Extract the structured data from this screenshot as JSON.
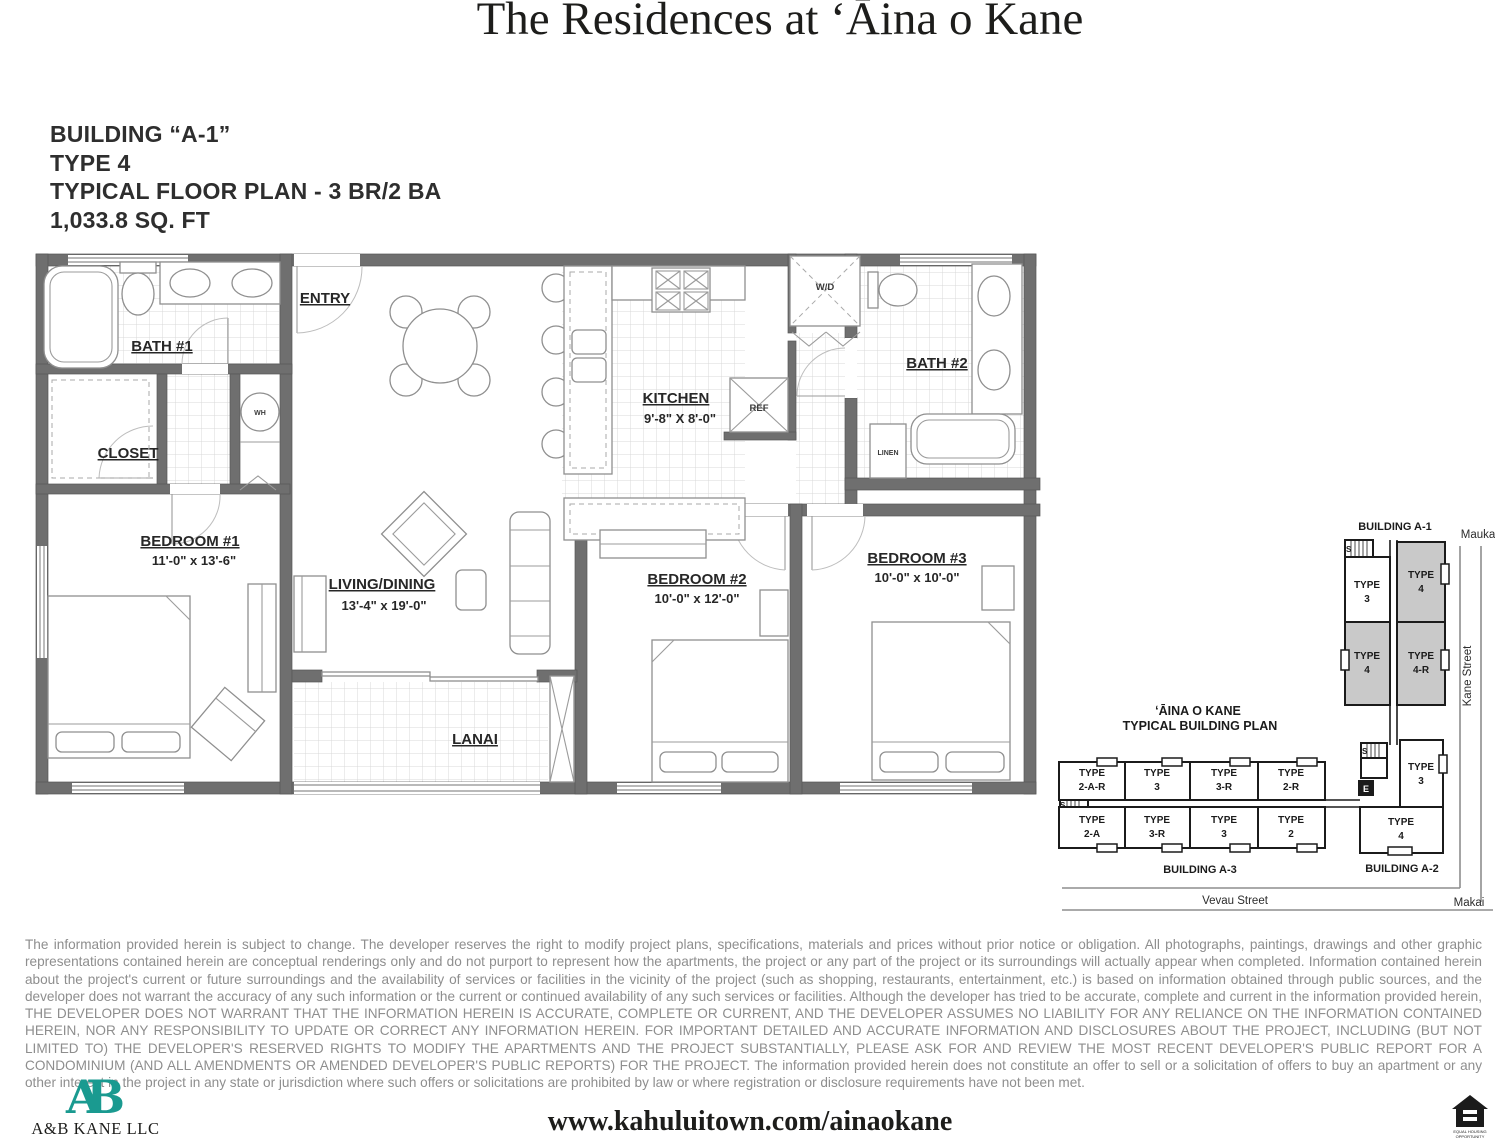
{
  "title": "The Residences at ʻĀina o Kane",
  "plan_info": {
    "building": "BUILDING “A-1”",
    "type": "TYPE 4",
    "floor_plan": "TYPICAL FLOOR PLAN - 3 BR/2 BA",
    "area": "1,033.8 SQ. FT"
  },
  "floor_plan": {
    "entry": {
      "name": "ENTRY"
    },
    "bath1": {
      "name": "BATH #1"
    },
    "closet": {
      "name": "CLOSET"
    },
    "wh": {
      "name": "WH"
    },
    "bedroom1": {
      "name": "BEDROOM #1",
      "dims": "11'-0\" x 13'-6\""
    },
    "living": {
      "name": "LIVING/DINING",
      "dims": "13'-4\" x 19'-0\""
    },
    "kitchen": {
      "name": "KITCHEN",
      "dims": "9'-8\" X 8'-0\""
    },
    "ref": {
      "name": "REF"
    },
    "wd": {
      "name": "W/D"
    },
    "bath2": {
      "name": "BATH #2"
    },
    "linen": {
      "name": "LINEN"
    },
    "bedroom2": {
      "name": "BEDROOM #2",
      "dims": "10'-0\" x 12'-0\""
    },
    "bedroom3": {
      "name": "BEDROOM #3",
      "dims": "10'-0\" x 10'-0\""
    },
    "lanai": {
      "name": "LANAI"
    }
  },
  "building_plan": {
    "title_line1": "ʻĀINA O KANE",
    "title_line2": "TYPICAL BUILDING PLAN",
    "building_a1_label": "BUILDING A-1",
    "building_a2_label": "BUILDING A-2",
    "building_a3_label": "BUILDING A-3",
    "mauka": "Mauka",
    "makai": "Makai",
    "kane_street": "Kane Street",
    "vevau_street": "Vevau Street",
    "stairs_label": "S",
    "elevator_label": "E",
    "a1_units": [
      {
        "name": "TYPE",
        "code": "3"
      },
      {
        "name": "TYPE",
        "code": "4"
      },
      {
        "name": "TYPE",
        "code": "4"
      },
      {
        "name": "TYPE",
        "code": "4-R"
      }
    ],
    "a3_units_top": [
      {
        "name": "TYPE",
        "code": "2-A-R"
      },
      {
        "name": "TYPE",
        "code": "3"
      },
      {
        "name": "TYPE",
        "code": "3-R"
      },
      {
        "name": "TYPE",
        "code": "2-R"
      }
    ],
    "a3_units_bottom": [
      {
        "name": "TYPE",
        "code": "2-A"
      },
      {
        "name": "TYPE",
        "code": "3-R"
      },
      {
        "name": "TYPE",
        "code": "3"
      },
      {
        "name": "TYPE",
        "code": "2"
      }
    ],
    "a2_units": [
      {
        "name": "TYPE",
        "code": "3"
      },
      {
        "name": "TYPE",
        "code": "4"
      }
    ]
  },
  "disclaimer": "The information provided herein is subject to change.  The developer reserves the right to modify project plans, specifications, materials and prices without prior notice or obligation.  All photographs, paintings, drawings and other graphic representations contained herein are conceptual renderings only and do not purport to represent how the apartments, the project or any part of the project or its surroundings will actually appear when completed.  Information contained herein about the project's current or future surroundings and the availability of services or facilities in the vicinity of the project (such as shopping, restaurants, entertainment, etc.) is based on information obtained through public sources, and the developer does not warrant the accuracy of any such information or the current or continued availability of any such services or facilities.  Although the developer has tried to be accurate, complete and current in the information provided herein, THE DEVELOPER DOES NOT WARRANT THAT THE INFORMATION HEREIN IS ACCURATE, COMPLETE OR CURRENT, AND THE DEVELOPER ASSUMES NO LIABILITY FOR ANY RELIANCE ON THE INFORMATION CONTAINED HEREIN, NOR ANY RESPONSIBILITY TO UPDATE OR CORRECT ANY INFORMATION HEREIN.  FOR IMPORTANT DETAILED AND ACCURATE INFORMATION AND DISCLOSURES ABOUT THE PROJECT, INCLUDING (BUT NOT LIMITED TO) THE DEVELOPER'S RESERVED RIGHTS TO MODIFY THE APARTMENTS AND THE PROJECT SUBSTANTIALLY, PLEASE ASK FOR AND REVIEW THE MOST RECENT DEVELOPER'S PUBLIC REPORT FOR A CONDOMINIUM (AND ALL AMENDMENTS OR AMENDED DEVELOPER'S PUBLIC REPORTS) FOR THE PROJECT.  The information provided herein does not constitute an offer to sell or a solicitation of offers to buy an apartment or any other interest in the project in any state or jurisdiction where such offers or solicitations are prohibited by law or where registration or disclosure requirements have not been met.",
  "footer": {
    "logo_monogram": "AB",
    "company": "A&B KANE LLC",
    "url": "www.kahuluitown.com/ainaokane",
    "equal_housing_line1": "EQUAL HOUSING",
    "equal_housing_line2": "OPPORTUNITY"
  },
  "colors": {
    "accent_teal": "#1A9A90",
    "wall_gray": "#6F6F6F",
    "unit_shade": "#C9C9C9",
    "disclaimer_gray": "#8E8E8E"
  }
}
